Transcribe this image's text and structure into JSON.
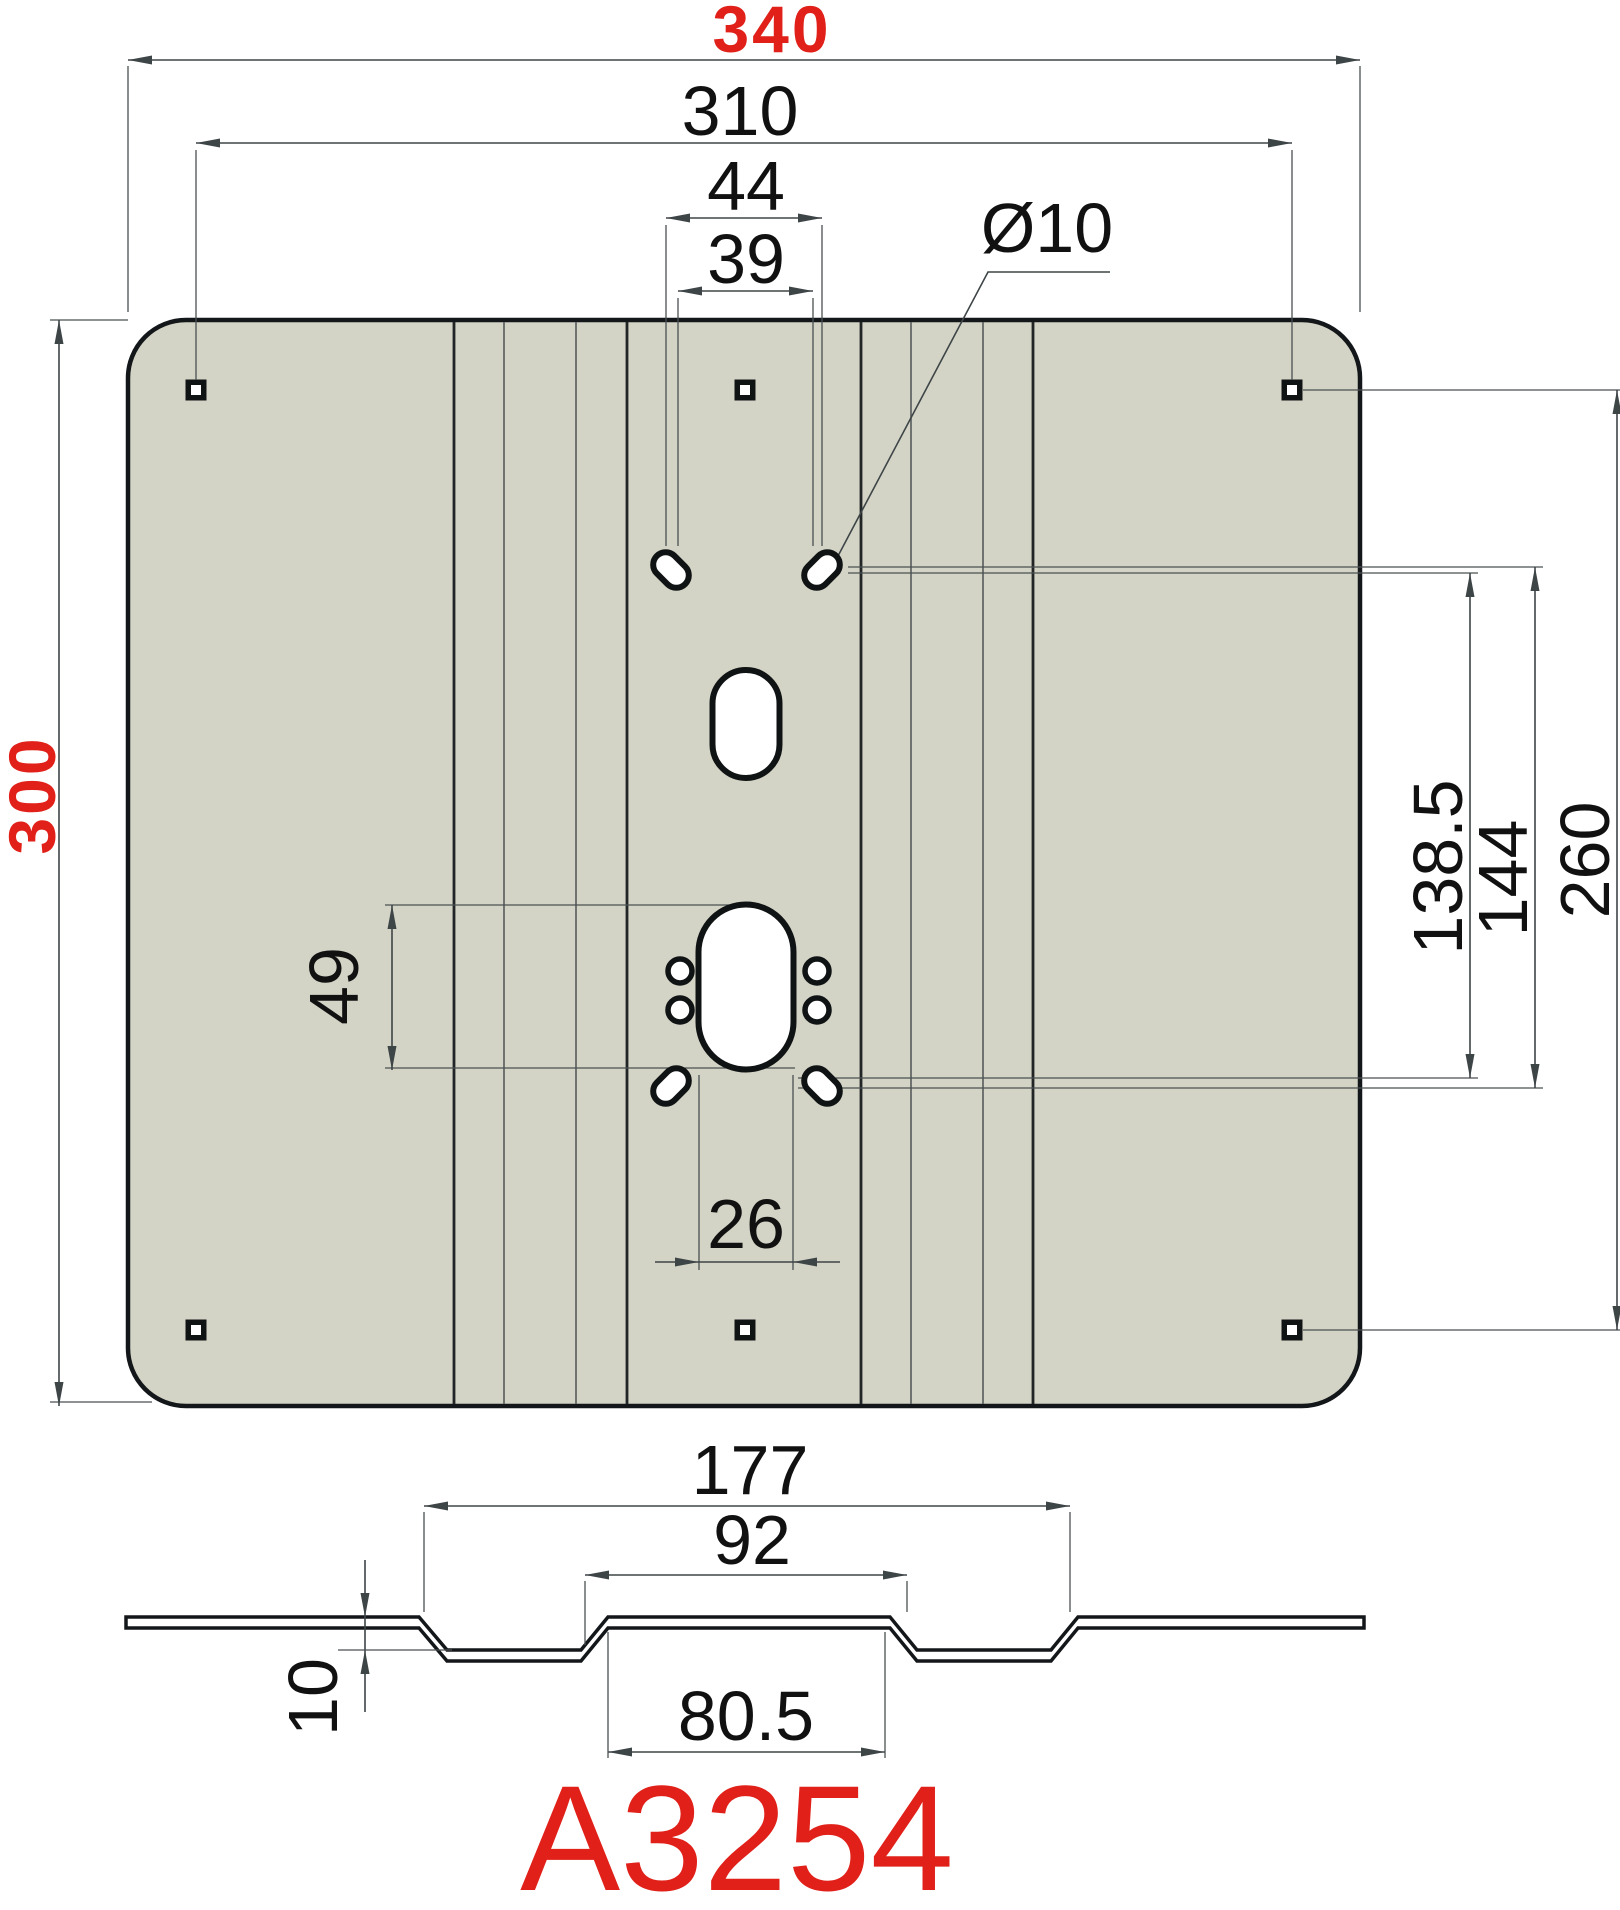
{
  "drawing": {
    "part_number": "A3254",
    "colors": {
      "highlight_red": "#e02019",
      "plate_fill": "#d3d4c6",
      "outline": "#14171a",
      "dimension_line": "#3e4547"
    },
    "top_view": {
      "overall_width": "340",
      "square_hole_span_horizontal": "310",
      "top_slot_span_outer": "44",
      "top_slot_span_inner": "39",
      "slot_diameter": "Ø10",
      "overall_height": "300",
      "slot_vertical_span_a": "138.5",
      "slot_vertical_span_b": "144",
      "square_hole_span_vertical": "260",
      "center_cutout_height": "49",
      "center_cutout_width": "26"
    },
    "section_view": {
      "channel_span_outer": "177",
      "channel_span_mid": "92",
      "channel_span_inner": "80.5",
      "channel_depth": "10"
    }
  }
}
